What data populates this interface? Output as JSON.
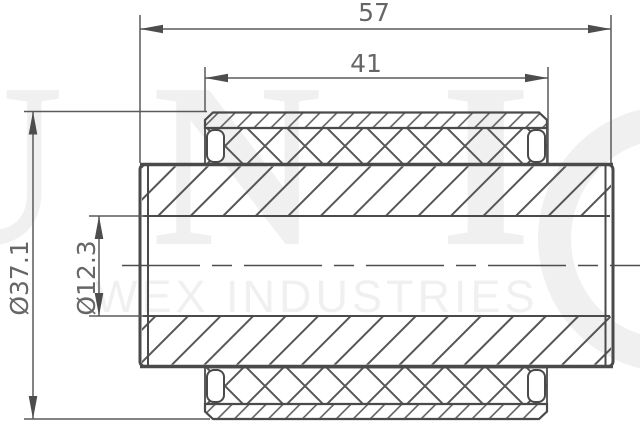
{
  "dimensions": {
    "overall_length": "57",
    "rubber_length": "41",
    "outer_diameter": "Ø37.1",
    "bore_diameter": "Ø12.3"
  },
  "watermark": {
    "letters": [
      "U",
      "N",
      "I"
    ],
    "ring_letter": "O",
    "subtitle": "WEX INDUSTRIES"
  },
  "colors": {
    "line": "#4a4a4a",
    "dim_line": "#5a5a5a",
    "dim_text": "#666666",
    "hatch": "#565656",
    "watermark": "#f0f0f0",
    "background": "#ffffff"
  }
}
